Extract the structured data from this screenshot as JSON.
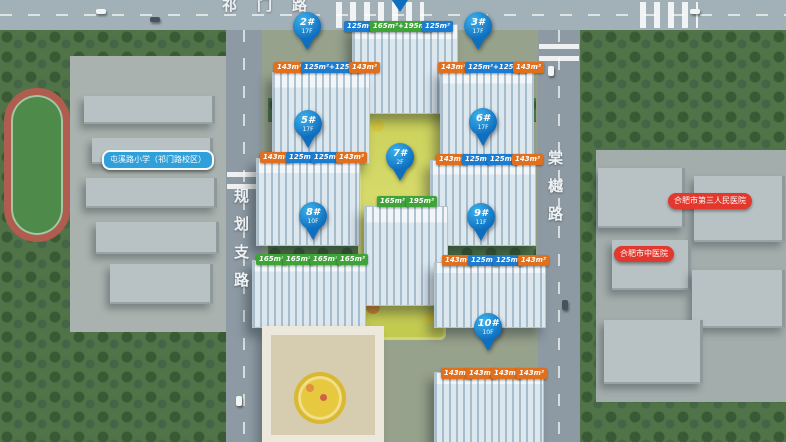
{
  "roads": {
    "top": "祁门路",
    "left": "规划支路",
    "right": "棠樾路"
  },
  "pins": [
    {
      "number": "2#",
      "floors": "17F"
    },
    {
      "number": "3#",
      "floors": "17F"
    },
    {
      "number": "5#",
      "floors": "17F"
    },
    {
      "number": "6#",
      "floors": "17F"
    },
    {
      "number": "7#",
      "floors": "2F"
    },
    {
      "number": "8#",
      "floors": "10F"
    },
    {
      "number": "9#",
      "floors": "11F"
    },
    {
      "number": "10#",
      "floors": "10F"
    }
  ],
  "unit_rows": [
    {
      "building": "1#",
      "tags": [
        {
          "label": "125m²"
        },
        {
          "label": "165m²+195m²"
        },
        {
          "label": "125m²"
        }
      ]
    },
    {
      "building": "2#",
      "tags": [
        {
          "label": "143m²"
        },
        {
          "label": "125m²+125m²"
        },
        {
          "label": "143m²"
        }
      ]
    },
    {
      "building": "3#",
      "tags": [
        {
          "label": "143m²"
        },
        {
          "label": "125m²+125m²"
        },
        {
          "label": "143m²"
        }
      ]
    },
    {
      "building": "5#",
      "tags": [
        {
          "label": "143m²"
        },
        {
          "label": "125m²"
        },
        {
          "label": "125m²"
        },
        {
          "label": "143m²"
        }
      ]
    },
    {
      "building": "6#",
      "tags": [
        {
          "label": "143m²"
        },
        {
          "label": "125m²"
        },
        {
          "label": "125m²"
        },
        {
          "label": "143m²"
        }
      ]
    },
    {
      "building": "7#",
      "tags": [
        {
          "label": "165m²"
        },
        {
          "label": "195m²"
        }
      ]
    },
    {
      "building": "8#",
      "tags": [
        {
          "label": "165m²"
        },
        {
          "label": "165m²"
        },
        {
          "label": "165m²"
        },
        {
          "label": "165m²"
        }
      ]
    },
    {
      "building": "9#",
      "tags": [
        {
          "label": "143m²"
        },
        {
          "label": "125m²"
        },
        {
          "label": "125m²"
        },
        {
          "label": "143m²"
        }
      ]
    },
    {
      "building": "10#",
      "tags": [
        {
          "label": "143m²"
        },
        {
          "label": "143m²"
        },
        {
          "label": "143m²"
        },
        {
          "label": "143m²"
        }
      ]
    }
  ],
  "pois": [
    {
      "label": "屯溪路小学（祁门路校区）",
      "type": "school"
    },
    {
      "label": "合肥市第三人民医院",
      "type": "hospital"
    },
    {
      "label": "合肥市中医院",
      "type": "hospital"
    }
  ],
  "colors": {
    "tag_orange": "#E0701E",
    "tag_blue": "#1B7CD0",
    "tag_green": "#3FA437",
    "pin_blue": "#0E6FC0",
    "poi_red": "#E2382D",
    "poi_blue": "#2FA0D9"
  }
}
